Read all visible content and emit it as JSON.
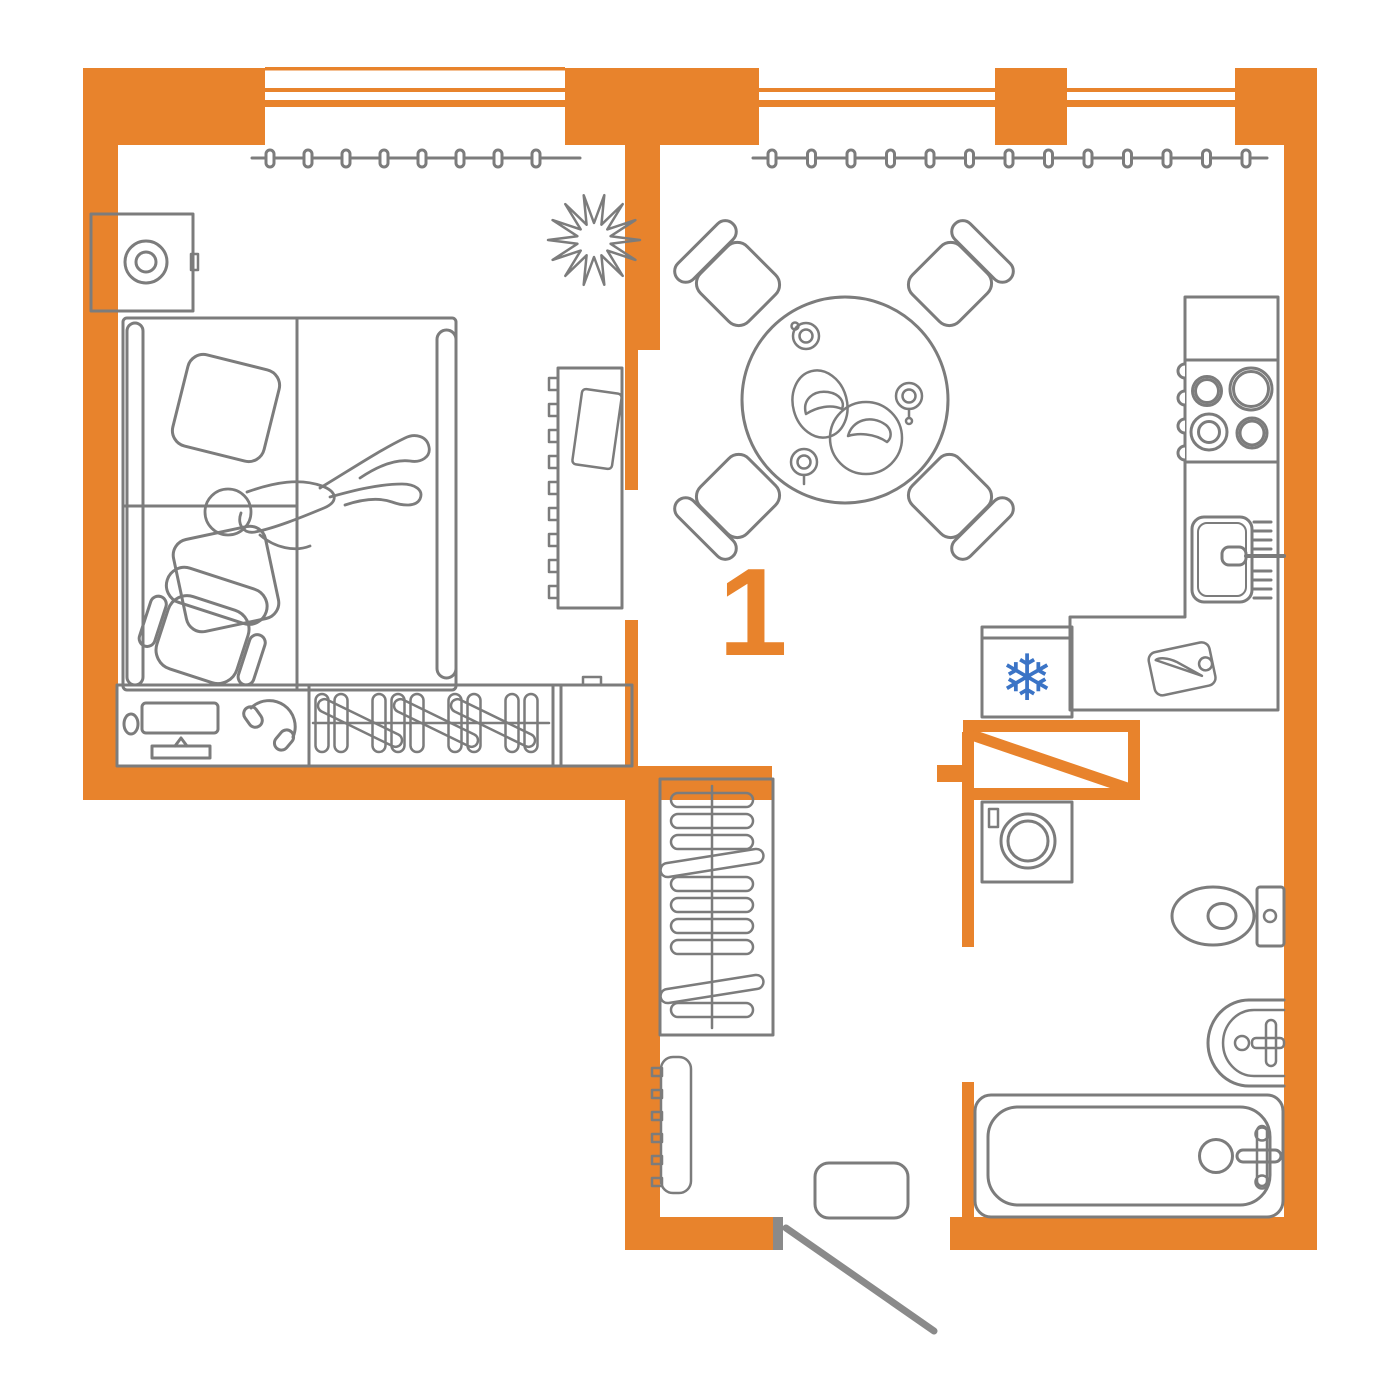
{
  "plan": {
    "unit_number": "1",
    "colors": {
      "wall_accent": "#E8832C",
      "furniture_line": "#7C7C7C",
      "fridge_snowflake_blue": "#3B74C6",
      "background": "#FFFFFF"
    },
    "icons": {
      "fridge_snowflake": "❄"
    }
  }
}
